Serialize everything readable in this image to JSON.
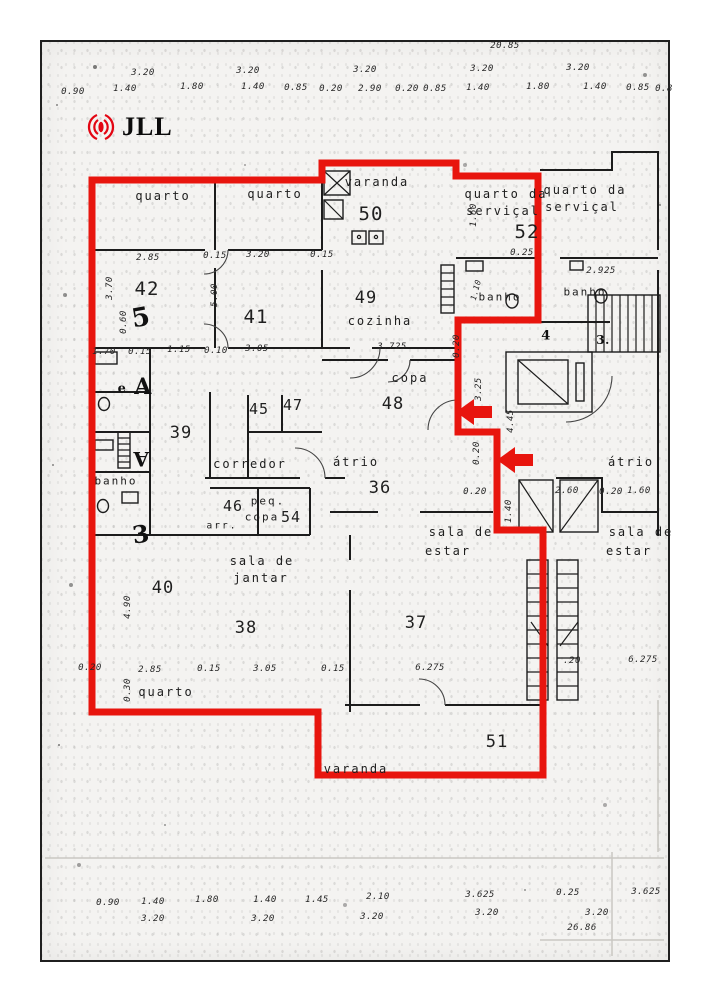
{
  "logo": {
    "text": "JLL",
    "icon": "jll-rings-icon",
    "icon_color": "#e30613",
    "text_color": "#0b0b0b"
  },
  "colors": {
    "highlight_red": "#e8150e",
    "wall_black": "#1c1c1c",
    "paper": "#f4f3f1"
  },
  "plan_labels": [
    {
      "t": "20.85",
      "x": 505,
      "y": 46,
      "s": 9
    },
    {
      "t": "3.20",
      "x": 143,
      "y": 73,
      "s": 9
    },
    {
      "t": "3.20",
      "x": 248,
      "y": 71,
      "s": 9
    },
    {
      "t": "3.20",
      "x": 365,
      "y": 70,
      "s": 9
    },
    {
      "t": "3.20",
      "x": 482,
      "y": 69,
      "s": 9
    },
    {
      "t": "3.20",
      "x": 578,
      "y": 68,
      "s": 9
    },
    {
      "t": "0.90",
      "x": 73,
      "y": 92,
      "s": 9
    },
    {
      "t": "1.40",
      "x": 125,
      "y": 89,
      "s": 9
    },
    {
      "t": "1.80",
      "x": 192,
      "y": 87,
      "s": 9
    },
    {
      "t": "1.40",
      "x": 253,
      "y": 87,
      "s": 9
    },
    {
      "t": "0.85",
      "x": 296,
      "y": 88,
      "s": 9
    },
    {
      "t": "0.20",
      "x": 331,
      "y": 89,
      "s": 9
    },
    {
      "t": "2.90",
      "x": 370,
      "y": 89,
      "s": 9
    },
    {
      "t": "0.20",
      "x": 407,
      "y": 89,
      "s": 9
    },
    {
      "t": "0.85",
      "x": 435,
      "y": 89,
      "s": 9
    },
    {
      "t": "1.40",
      "x": 478,
      "y": 88,
      "s": 9
    },
    {
      "t": "1.80",
      "x": 538,
      "y": 87,
      "s": 9
    },
    {
      "t": "1.40",
      "x": 595,
      "y": 87,
      "s": 9
    },
    {
      "t": "0.85",
      "x": 638,
      "y": 88,
      "s": 9
    },
    {
      "t": "0.8",
      "x": 664,
      "y": 89,
      "s": 9
    },
    {
      "t": "quarto",
      "x": 163,
      "y": 196,
      "s": 12,
      "c": "room"
    },
    {
      "t": "quarto",
      "x": 275,
      "y": 194,
      "s": 12,
      "c": "room"
    },
    {
      "t": "varanda",
      "x": 377,
      "y": 182,
      "s": 12,
      "c": "room"
    },
    {
      "t": "50",
      "x": 371,
      "y": 214,
      "s": 19,
      "c": "num"
    },
    {
      "t": "quarto da",
      "x": 506,
      "y": 194,
      "s": 12,
      "c": "room"
    },
    {
      "t": "serviçal",
      "x": 503,
      "y": 211,
      "s": 12,
      "c": "room"
    },
    {
      "t": "52",
      "x": 527,
      "y": 232,
      "s": 19,
      "c": "num"
    },
    {
      "t": "quarto da",
      "x": 585,
      "y": 190,
      "s": 12,
      "c": "room"
    },
    {
      "t": "serviçal",
      "x": 582,
      "y": 207,
      "s": 12,
      "c": "room"
    },
    {
      "t": "2.85",
      "x": 148,
      "y": 258,
      "s": 9
    },
    {
      "t": "0.15",
      "x": 215,
      "y": 256,
      "s": 9
    },
    {
      "t": "3.20",
      "x": 258,
      "y": 255,
      "s": 9
    },
    {
      "t": "0.15",
      "x": 322,
      "y": 255,
      "s": 9
    },
    {
      "t": "0.25",
      "x": 522,
      "y": 253,
      "s": 9
    },
    {
      "t": "2.925",
      "x": 601,
      "y": 271,
      "s": 9
    },
    {
      "t": "3.70",
      "x": 110,
      "y": 288,
      "s": 9,
      "r": -90
    },
    {
      "t": "5.00",
      "x": 215,
      "y": 295,
      "s": 9,
      "r": -90
    },
    {
      "t": "0.60",
      "x": 124,
      "y": 322,
      "s": 9,
      "r": -90
    },
    {
      "t": "1.60",
      "x": 474,
      "y": 215,
      "s": 9,
      "r": -90
    },
    {
      "t": "1.10",
      "x": 476,
      "y": 290,
      "s": 8,
      "r": -75
    },
    {
      "t": "42",
      "x": 147,
      "y": 289,
      "s": 19,
      "c": "num"
    },
    {
      "t": "41",
      "x": 256,
      "y": 317,
      "s": 19,
      "c": "num"
    },
    {
      "t": "49",
      "x": 366,
      "y": 298,
      "s": 17,
      "c": "num"
    },
    {
      "t": "cozinha",
      "x": 380,
      "y": 321,
      "s": 12,
      "c": "room"
    },
    {
      "t": "banho",
      "x": 500,
      "y": 297,
      "s": 11,
      "c": "room"
    },
    {
      "t": "banho",
      "x": 585,
      "y": 292,
      "s": 11,
      "c": "room"
    },
    {
      "t": "3.725",
      "x": 392,
      "y": 347,
      "s": 9
    },
    {
      "t": "copa",
      "x": 410,
      "y": 378,
      "s": 12,
      "c": "room"
    },
    {
      "t": "48",
      "x": 393,
      "y": 404,
      "s": 17,
      "c": "num"
    },
    {
      "t": "0.20",
      "x": 457,
      "y": 346,
      "s": 9,
      "r": -90
    },
    {
      "t": "3.25",
      "x": 479,
      "y": 389,
      "s": 9,
      "r": -90
    },
    {
      "t": "4.45",
      "x": 511,
      "y": 421,
      "s": 9,
      "r": -90
    },
    {
      "t": "0.20",
      "x": 477,
      "y": 453,
      "s": 9,
      "r": -90
    },
    {
      "t": "1.70",
      "x": 104,
      "y": 352,
      "s": 9
    },
    {
      "t": "0.15",
      "x": 140,
      "y": 352,
      "s": 9
    },
    {
      "t": "1.15",
      "x": 179,
      "y": 350,
      "s": 9
    },
    {
      "t": "0.10",
      "x": 216,
      "y": 351,
      "s": 9
    },
    {
      "t": "3.05",
      "x": 257,
      "y": 349,
      "s": 9
    },
    {
      "t": "39",
      "x": 181,
      "y": 433,
      "s": 17,
      "c": "num"
    },
    {
      "t": "45",
      "x": 259,
      "y": 409,
      "s": 15,
      "c": "num"
    },
    {
      "t": "47",
      "x": 293,
      "y": 405,
      "s": 15,
      "c": "num"
    },
    {
      "t": "corredor",
      "x": 250,
      "y": 464,
      "s": 12,
      "c": "room"
    },
    {
      "t": "átrio",
      "x": 356,
      "y": 462,
      "s": 12,
      "c": "room"
    },
    {
      "t": "36",
      "x": 380,
      "y": 488,
      "s": 17,
      "c": "num"
    },
    {
      "t": "átrio",
      "x": 631,
      "y": 462,
      "s": 12,
      "c": "room"
    },
    {
      "t": "46",
      "x": 233,
      "y": 506,
      "s": 15,
      "c": "num"
    },
    {
      "t": "peq.",
      "x": 268,
      "y": 501,
      "s": 11,
      "c": "room"
    },
    {
      "t": "copa",
      "x": 262,
      "y": 517,
      "s": 11,
      "c": "room"
    },
    {
      "t": "54",
      "x": 291,
      "y": 517,
      "s": 15,
      "c": "num"
    },
    {
      "t": "arr.",
      "x": 222,
      "y": 526,
      "s": 9.5,
      "c": "room"
    },
    {
      "t": "banho",
      "x": 116,
      "y": 481,
      "s": 11,
      "c": "room"
    },
    {
      "t": "5",
      "x": 141,
      "y": 318,
      "s": 26,
      "c": "script",
      "r": -10
    },
    {
      "t": "A",
      "x": 143,
      "y": 387,
      "s": 22,
      "c": "script"
    },
    {
      "t": "e",
      "x": 122,
      "y": 389,
      "s": 13,
      "c": "script"
    },
    {
      "t": "A",
      "x": 141,
      "y": 459,
      "s": 20,
      "c": "script",
      "r": 180
    },
    {
      "t": "3",
      "x": 141,
      "y": 534,
      "s": 24,
      "c": "script",
      "r": -8
    },
    {
      "t": "4",
      "x": 546,
      "y": 336,
      "s": 13,
      "c": "script"
    },
    {
      "t": "3.",
      "x": 603,
      "y": 340,
      "s": 12,
      "c": "script"
    },
    {
      "t": "0.20",
      "x": 475,
      "y": 492,
      "s": 9
    },
    {
      "t": "2.60",
      "x": 567,
      "y": 491,
      "s": 9
    },
    {
      "t": "0.20",
      "x": 611,
      "y": 492,
      "s": 9
    },
    {
      "t": "1.60",
      "x": 639,
      "y": 491,
      "s": 9
    },
    {
      "t": "1.40",
      "x": 509,
      "y": 511,
      "s": 9,
      "r": -90
    },
    {
      "t": "sala de",
      "x": 461,
      "y": 532,
      "s": 12,
      "c": "room"
    },
    {
      "t": "estar",
      "x": 448,
      "y": 551,
      "s": 12,
      "c": "room"
    },
    {
      "t": "sala de",
      "x": 641,
      "y": 532,
      "s": 12,
      "c": "room"
    },
    {
      "t": "estar",
      "x": 629,
      "y": 551,
      "s": 12,
      "c": "room"
    },
    {
      "t": "sala de",
      "x": 262,
      "y": 561,
      "s": 12,
      "c": "room"
    },
    {
      "t": "jantar",
      "x": 261,
      "y": 578,
      "s": 12,
      "c": "room"
    },
    {
      "t": "40",
      "x": 163,
      "y": 588,
      "s": 17,
      "c": "num"
    },
    {
      "t": "4.90",
      "x": 128,
      "y": 607,
      "s": 9,
      "r": -90
    },
    {
      "t": "38",
      "x": 246,
      "y": 628,
      "s": 17,
      "c": "num"
    },
    {
      "t": "37",
      "x": 416,
      "y": 623,
      "s": 17,
      "c": "num"
    },
    {
      "t": "0.20",
      "x": 90,
      "y": 668,
      "s": 9
    },
    {
      "t": "2.85",
      "x": 150,
      "y": 670,
      "s": 9
    },
    {
      "t": "0.15",
      "x": 209,
      "y": 669,
      "s": 9
    },
    {
      "t": "3.05",
      "x": 265,
      "y": 669,
      "s": 9
    },
    {
      "t": "0.15",
      "x": 333,
      "y": 669,
      "s": 9
    },
    {
      "t": "6.275",
      "x": 430,
      "y": 668,
      "s": 9
    },
    {
      "t": ".20",
      "x": 572,
      "y": 661,
      "s": 9
    },
    {
      "t": "6.275",
      "x": 643,
      "y": 660,
      "s": 9
    },
    {
      "t": "0.30",
      "x": 128,
      "y": 690,
      "s": 9,
      "r": -90
    },
    {
      "t": "quarto",
      "x": 166,
      "y": 692,
      "s": 12,
      "c": "room"
    },
    {
      "t": "51",
      "x": 497,
      "y": 742,
      "s": 17,
      "c": "num"
    },
    {
      "t": "varanda",
      "x": 356,
      "y": 769,
      "s": 12,
      "c": "room"
    },
    {
      "t": "0.90",
      "x": 108,
      "y": 903,
      "s": 9
    },
    {
      "t": "1.40",
      "x": 153,
      "y": 902,
      "s": 9
    },
    {
      "t": "1.80",
      "x": 207,
      "y": 900,
      "s": 9
    },
    {
      "t": "1.40",
      "x": 265,
      "y": 900,
      "s": 9
    },
    {
      "t": "1.45",
      "x": 317,
      "y": 900,
      "s": 9
    },
    {
      "t": "2.10",
      "x": 378,
      "y": 897,
      "s": 9
    },
    {
      "t": "3.625",
      "x": 480,
      "y": 895,
      "s": 9
    },
    {
      "t": "0.25",
      "x": 568,
      "y": 893,
      "s": 9
    },
    {
      "t": "3.625",
      "x": 646,
      "y": 892,
      "s": 9
    },
    {
      "t": "3.20",
      "x": 153,
      "y": 919,
      "s": 9
    },
    {
      "t": "3.20",
      "x": 263,
      "y": 919,
      "s": 9
    },
    {
      "t": "3.20",
      "x": 372,
      "y": 917,
      "s": 9
    },
    {
      "t": "3.20",
      "x": 487,
      "y": 913,
      "s": 9
    },
    {
      "t": "3.20",
      "x": 597,
      "y": 913,
      "s": 9
    },
    {
      "t": "26.86",
      "x": 582,
      "y": 928,
      "s": 9
    }
  ]
}
